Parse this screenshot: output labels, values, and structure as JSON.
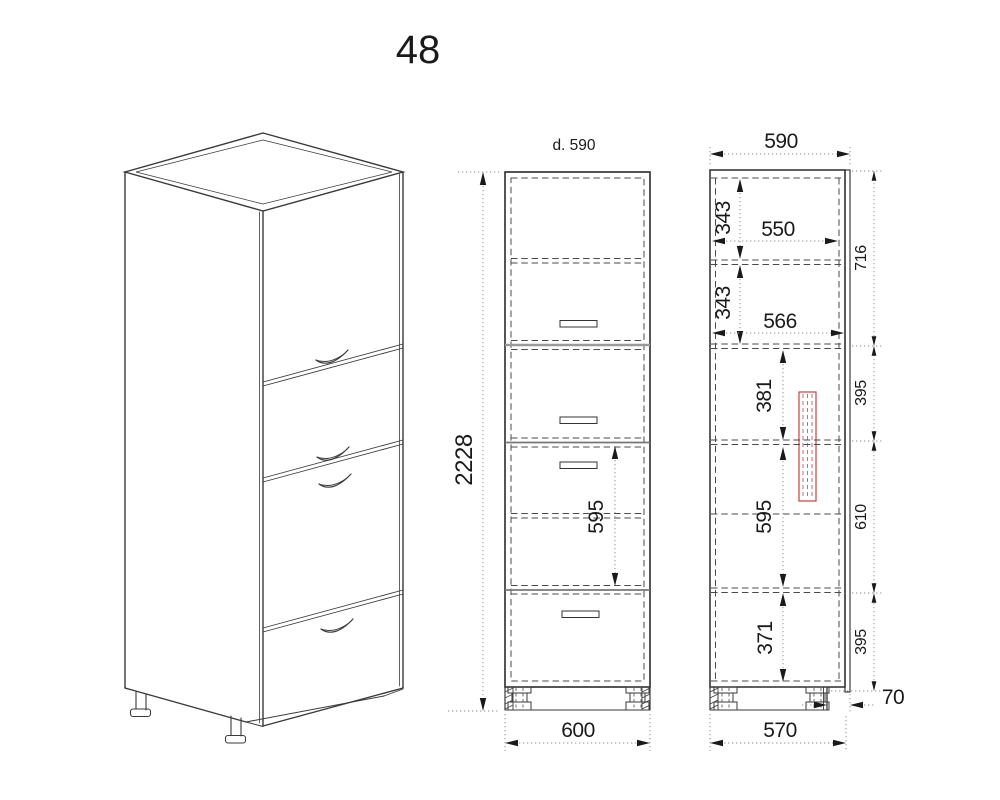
{
  "title": "48",
  "front_view": {
    "top_label": "d. 590",
    "height": "2228",
    "cavity_height": "595",
    "bottom_width": "600"
  },
  "side_view": {
    "top_depth": "590",
    "upper_gap": "343",
    "shelf_depth": "550",
    "lower_gap": "343",
    "interior_depth": "566",
    "niche_upper": "381",
    "niche_middle": "595",
    "niche_lower": "371",
    "right_segments": [
      "716",
      "395",
      "610",
      "395"
    ],
    "plinth_recess": "70",
    "bottom_depth": "570"
  },
  "colors": {
    "line": "#3a3a3a",
    "hidden_line": "#4a4a4a",
    "dimension_line": "#909090",
    "division_line": "#9a9a9a",
    "highlight": "#cc4040",
    "background": "#ffffff"
  }
}
